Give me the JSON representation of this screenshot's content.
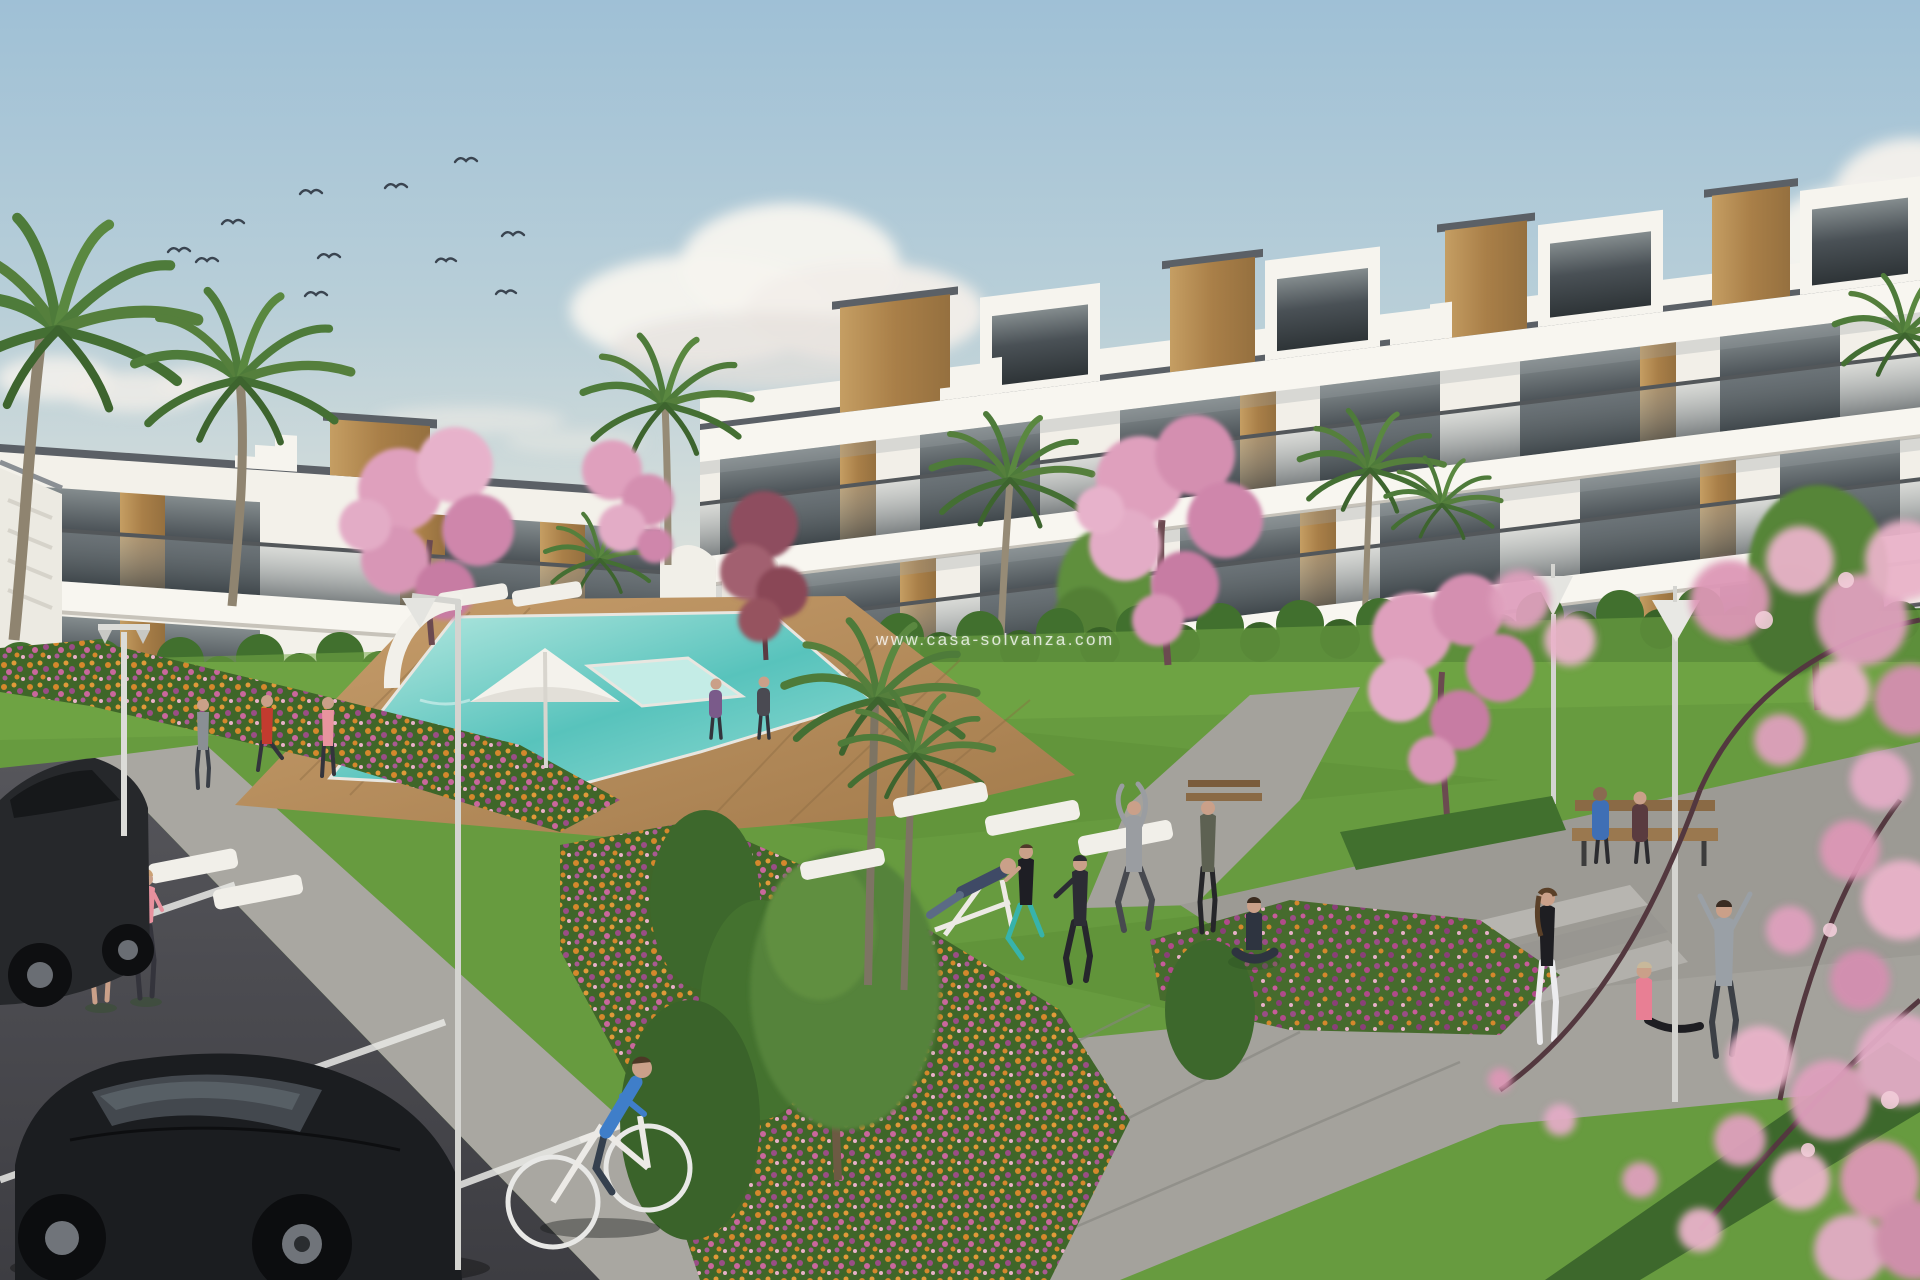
{
  "watermark": {
    "text": "www.casa-solvanza.com"
  },
  "scene": {
    "type": "architectural-render",
    "birds_count": 11,
    "palette": {
      "sky_top": "#9fc0d6",
      "sky_horizon": "#ecebe2",
      "cloud": "#f7f4ef",
      "building_white": "#f6f4ee",
      "building_shade": "#e7e3da",
      "roof_edge": "#5b6066",
      "wood": "#b8905a",
      "glass": "#3b4247",
      "balustrade": "#8b9398",
      "grass": "#679b3f",
      "hedge": "#41702e",
      "palm_green": "#4e7b3a",
      "pool_light": "#bdebe3",
      "pool_deep": "#58c3bc",
      "deck_wood": "#b78d5c",
      "path_grey": "#a4a29c",
      "road_asphalt": "#4e4e52",
      "line_white": "#e9e9e6",
      "flower_orange": "#d5882c",
      "flower_pink": "#c9679c",
      "flower_purple": "#9a4d86",
      "blossom_pink": "#dfa0bd",
      "leaf_red": "#8e4d5e",
      "skin": "#c9a089"
    }
  }
}
